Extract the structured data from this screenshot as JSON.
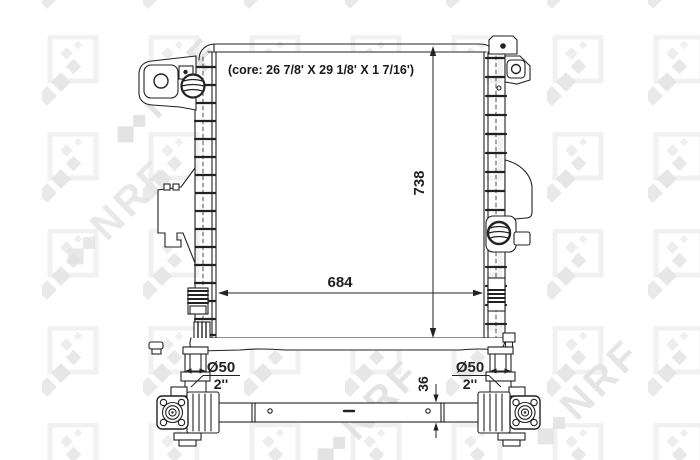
{
  "drawing": {
    "watermark_text": "NRF",
    "front_view": {
      "core_label": "(core: 26 7/8' X 29 1/8' X 1 7/16')",
      "height_dim": "738",
      "width_dim": "684"
    },
    "bottom_view": {
      "tube_height_dim": "36",
      "left_fitting": {
        "diameter_label": "Ø50",
        "size_label": "2''"
      },
      "right_fitting": {
        "diameter_label": "Ø50",
        "size_label": "2''"
      }
    },
    "colors": {
      "line": "#222222",
      "background": "#ffffff",
      "watermark": "#e9e9e9"
    }
  }
}
